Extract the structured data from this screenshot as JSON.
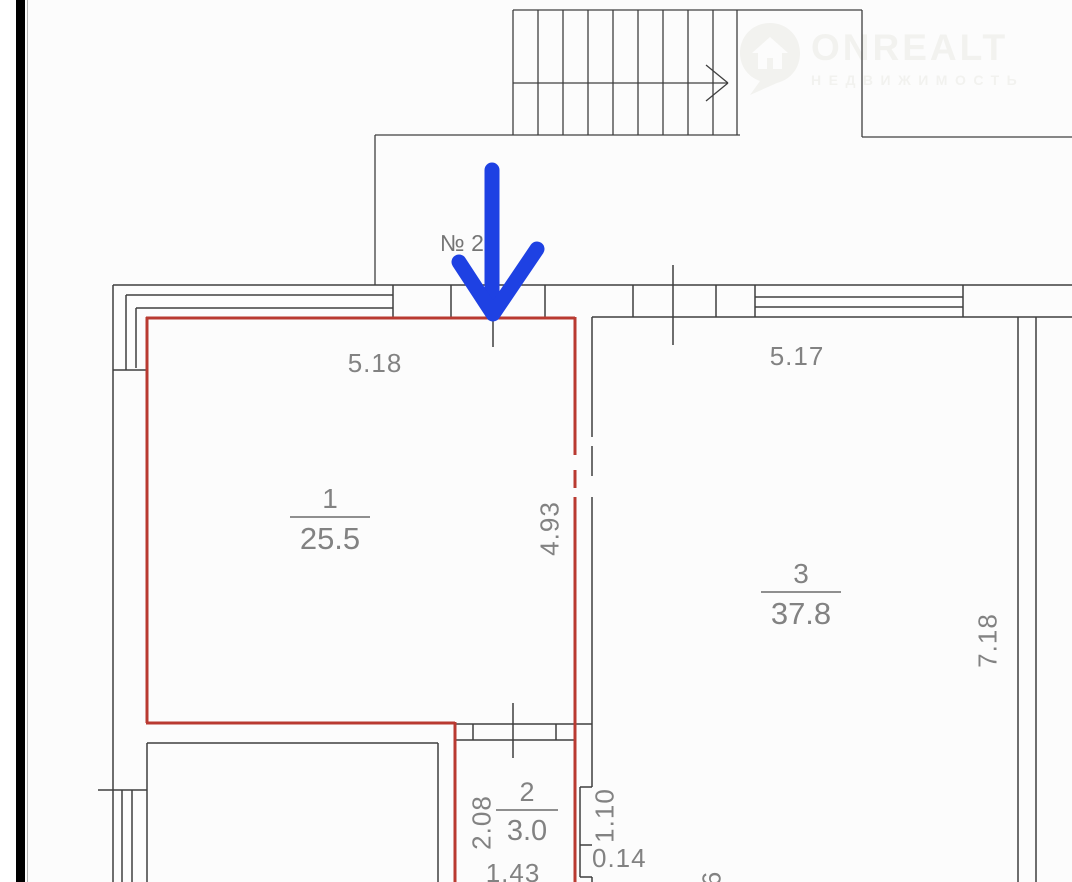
{
  "colors": {
    "highlight_red": "#b93a31",
    "arrow_blue": "#1e41e3",
    "wall_line": "#3f3f3f",
    "dim_text": "#828282"
  },
  "watermark": {
    "brand": "ONREALT",
    "subtitle": "НЕДВИЖИМОСТЬ"
  },
  "plan": {
    "unit_label": "№ 2",
    "rooms": [
      {
        "number": "1",
        "area": "25.5",
        "top_dim": "5.18",
        "side_dim": "4.93"
      },
      {
        "number": "2",
        "area": "3.0",
        "side_dim": "2.08",
        "bottom_dim": "1.43"
      },
      {
        "number": "3",
        "area": "37.8",
        "top_dim": "5.17",
        "side_dim": "7.18"
      }
    ],
    "extra_dims": {
      "niche_height": "1.10",
      "niche_depth": "0.14",
      "partial_edge": "6"
    }
  }
}
